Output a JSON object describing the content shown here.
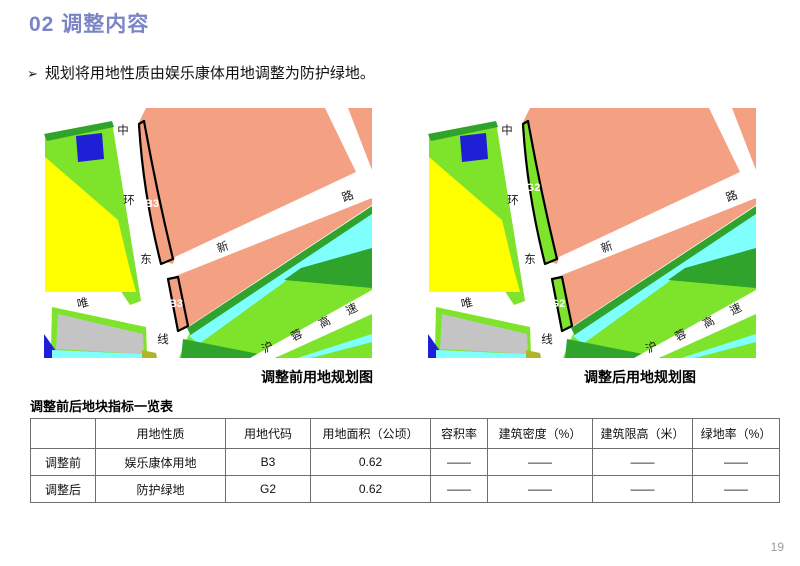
{
  "page": {
    "title": "02 调整内容",
    "page_number": "19"
  },
  "bullet": {
    "marker": "➢",
    "text": "规划将用地性质由娱乐康体用地调整为防护绿地。"
  },
  "maps": {
    "road_labels": {
      "ring_road": [
        "中",
        "环",
        "东",
        "线"
      ],
      "new_road": [
        "新",
        "路"
      ],
      "wei_road": "唯",
      "expressway": [
        "沪",
        "蓉",
        "高",
        "速"
      ]
    },
    "before": {
      "caption": "调整前用地规划图",
      "parcel_code": "B3"
    },
    "after": {
      "caption": "调整后用地规划图",
      "parcel_code": "G2"
    }
  },
  "table": {
    "title": "调整前后地块指标一览表",
    "headers": [
      "",
      "用地性质",
      "用地代码",
      "用地面积（公顷）",
      "容积率",
      "建筑密度（%）",
      "建筑限高（米）",
      "绿地率（%）"
    ],
    "rows": [
      {
        "cells": [
          "调整前",
          "娱乐康体用地",
          "B3",
          "0.62",
          "——",
          "——",
          "——",
          "——"
        ]
      },
      {
        "cells": [
          "调整后",
          "防护绿地",
          "G2",
          "0.62",
          "——",
          "——",
          "——",
          "——"
        ]
      }
    ]
  },
  "colors": {
    "title_text": "#7B85C6",
    "parcel_fill_before": "#F4A183",
    "parcel_fill_after": "#7DE32B",
    "map_pink": "#F4A183",
    "map_light_green": "#7DE32B",
    "map_dark_green": "#2FA32C",
    "map_yellow": "#FFFF00",
    "map_cyan": "#80FFFF",
    "map_blue": "#1F1FD6",
    "map_gray": "#C4C4C4",
    "map_olive": "#AFB52B"
  }
}
